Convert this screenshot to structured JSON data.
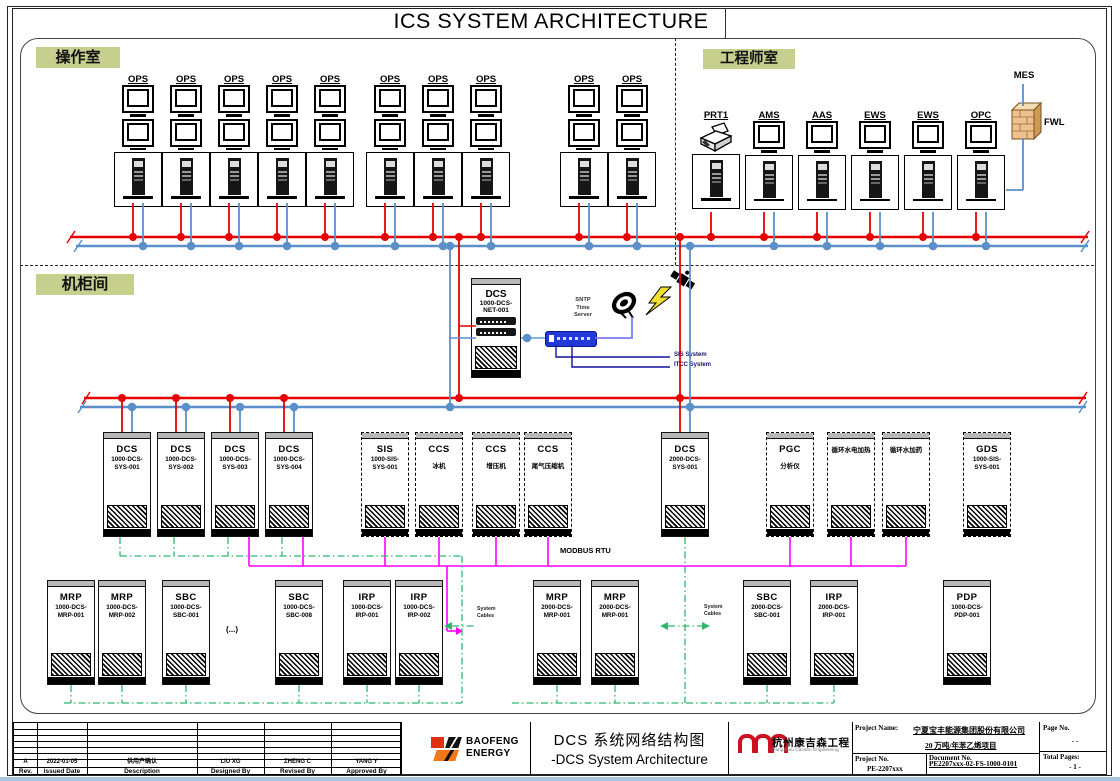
{
  "title": "ICS SYSTEM ARCHITECTURE",
  "rooms": {
    "operator": "操作室",
    "engineer": "工程师室",
    "cabinet": "机柜间"
  },
  "colors": {
    "red_bus": "#e60000",
    "blue_bus": "#5b8fc9",
    "magenta": "#ff00ff",
    "green": "#2eb86e",
    "violet": "#7b7bf0",
    "navy": "#1010a0",
    "room_label_bg": "#c6cf8e",
    "switch_blue": "#2238d8"
  },
  "operator_room": {
    "stations": [
      {
        "label": "OPS",
        "x": 138
      },
      {
        "label": "OPS",
        "x": 186
      },
      {
        "label": "OPS",
        "x": 234
      },
      {
        "label": "OPS",
        "x": 282
      },
      {
        "label": "OPS",
        "x": 330
      },
      {
        "label": "OPS",
        "x": 390
      },
      {
        "label": "OPS",
        "x": 438
      },
      {
        "label": "OPS",
        "x": 486
      },
      {
        "label": "OPS",
        "x": 584
      },
      {
        "label": "OPS",
        "x": 632
      }
    ]
  },
  "engineer_room": {
    "stations": [
      {
        "label": "PRT1",
        "x": 716,
        "printer": true
      },
      {
        "label": "AMS",
        "x": 769
      },
      {
        "label": "AAS",
        "x": 822
      },
      {
        "label": "EWS",
        "x": 875
      },
      {
        "label": "EWS",
        "x": 928
      },
      {
        "label": "OPC",
        "x": 981
      }
    ]
  },
  "mes_label": "MES",
  "fwl_label": "FWL",
  "net_cabinet": {
    "l1": "DCS",
    "l2": "1000-DCS-",
    "l3": "NET-001"
  },
  "sntp": {
    "l1": "SNTP",
    "l2": "Time",
    "l3": "Server"
  },
  "ext_systems": {
    "sis": "SIS System",
    "itcc": "ITCC System"
  },
  "modbus_label": "MODBUS RTU",
  "system_cables": {
    "line1": "System",
    "line2": "Cables"
  },
  "ellipsis": "(...)",
  "row1_cabinets": [
    {
      "l1": "DCS",
      "l2": "1000-DCS-",
      "l3": "SYS-001",
      "x": 103,
      "conn": "redblue"
    },
    {
      "l1": "DCS",
      "l2": "1000-DCS-",
      "l3": "SYS-002",
      "x": 157,
      "conn": "redblue"
    },
    {
      "l1": "DCS",
      "l2": "1000-DCS-",
      "l3": "SYS-003",
      "x": 211,
      "conn": "redblue-modbus"
    },
    {
      "l1": "DCS",
      "l2": "1000-DCS-",
      "l3": "SYS-004",
      "x": 265,
      "conn": "redblue-modbus"
    },
    {
      "l1": "SIS",
      "l2": "1000-SIS-",
      "l3": "SYS-001",
      "x": 361,
      "dashed": true,
      "conn": "modbus"
    },
    {
      "l1": "CCS",
      "zh": "冰机",
      "x": 415,
      "dashed": true,
      "conn": "modbus"
    },
    {
      "l1": "CCS",
      "zh": "增压机",
      "x": 472,
      "dashed": true,
      "conn": "modbus"
    },
    {
      "l1": "CCS",
      "zh": "尾气压缩机",
      "x": 524,
      "dashed": true,
      "conn": "modbus"
    },
    {
      "l1": "DCS",
      "l2": "2000-DCS-",
      "l3": "SYS-001",
      "x": 661,
      "conn": "trunk"
    },
    {
      "l1": "PGC",
      "zh": "分析仪",
      "x": 766,
      "dashed": true,
      "conn": "modbus"
    },
    {
      "zh": "循环水电加热",
      "x": 827,
      "dashed": true,
      "conn": "modbus"
    },
    {
      "zh": "循环水加药",
      "x": 882,
      "dashed": true,
      "conn": "modbus"
    },
    {
      "l1": "GDS",
      "l2": "1000-SIS-",
      "l3": "SYS-001",
      "x": 963,
      "dashed": true,
      "conn": "none"
    }
  ],
  "row2_cabinets": [
    {
      "l1": "MRP",
      "l2": "1000-DCS-",
      "l3": "MRP-001",
      "x": 47,
      "conn": "green"
    },
    {
      "l1": "MRP",
      "l2": "1000-DCS-",
      "l3": "MRP-002",
      "x": 98,
      "conn": "green"
    },
    {
      "l1": "SBC",
      "l2": "1000-DCS-",
      "l3": "SBC-001",
      "x": 162,
      "conn": "green"
    },
    {
      "l1": "SBC",
      "l2": "1000-DCS-",
      "l3": "SBC-008",
      "x": 275,
      "conn": "green"
    },
    {
      "l1": "IRP",
      "l2": "1000-DCS-",
      "l3": "IRP-001",
      "x": 343,
      "conn": "green"
    },
    {
      "l1": "IRP",
      "l2": "1000-DCS-",
      "l3": "IRP-002",
      "x": 395,
      "conn": "green"
    },
    {
      "l1": "MRP",
      "l2": "2000-DCS-",
      "l3": "MRP-001",
      "x": 533,
      "conn": "green"
    },
    {
      "l1": "MRP",
      "l2": "2000-DCS-",
      "l3": "MRP-001",
      "x": 591,
      "conn": "green"
    },
    {
      "l1": "SBC",
      "l2": "2000-DCS-",
      "l3": "SBC-001",
      "x": 743,
      "conn": "green"
    },
    {
      "l1": "IRP",
      "l2": "2000-DCS-",
      "l3": "IRP-001",
      "x": 810,
      "conn": "green"
    },
    {
      "l1": "PDP",
      "l2": "1000-DCS-",
      "l3": "PDP-001",
      "x": 943,
      "conn": "none"
    }
  ],
  "titleblock": {
    "rev": {
      "values": [
        "A",
        "2022-01-05",
        "供用户确认",
        "LIU XG",
        "ZHENG C",
        "YANG Y"
      ],
      "labels": [
        "Rev.",
        "Issued Date",
        "Description",
        "Designed By",
        "Revised By",
        "Approved By"
      ]
    },
    "baofeng": {
      "name1": "BAOFENG",
      "name2": "ENERGY"
    },
    "drawing_title_zh": "DCS 系统网络结构图",
    "drawing_title_en": "-DCS System Architecture",
    "cansen": {
      "zh": "杭州康吉森工程",
      "en": "Hangzhou Cansen Engineering"
    },
    "project_name_label": "Project Name:",
    "project_name_1": "宁夏宝丰能源集团股份有限公司",
    "project_name_2": "20 万吨/年苯乙烯项目",
    "page_no_label": "Page No.",
    "page_no": "-   -",
    "project_no_label": "Project No.",
    "project_no": "PE-2207xxx",
    "doc_no_label": "Document No.",
    "doc_no": "PE2207xxx-02-FS-1000-0101",
    "total_pages_label": "Total Pages:",
    "total_pages": "- 1 -"
  }
}
